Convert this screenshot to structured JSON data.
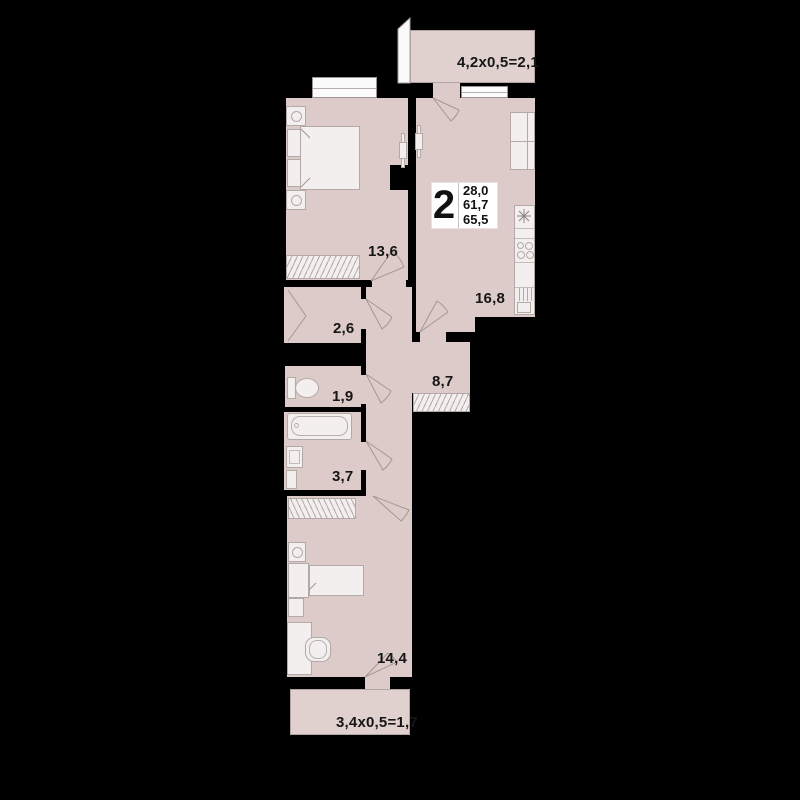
{
  "apartment": {
    "badge": {
      "rooms_count": "2",
      "area_lines": {
        "living": "28,0",
        "usable": "61,7",
        "total": "65,5"
      }
    },
    "rooms": {
      "bedroom": {
        "area": "13,6"
      },
      "kitchen_living": {
        "area": "16,8"
      },
      "closet": {
        "area": "2,6"
      },
      "wc": {
        "area": "1,9"
      },
      "hallway": {
        "area": "8,7"
      },
      "bathroom": {
        "area": "3,7"
      },
      "bedroom2": {
        "area": "14,4"
      }
    },
    "balconies": {
      "top": {
        "label": "4,2x0,5=2,1"
      },
      "bottom": {
        "label": "3,4x0,5=1,7"
      }
    },
    "colors": {
      "floor": "#dccbc9",
      "furniture": "#f3efee",
      "wall": "#000000",
      "line": "#a3988f",
      "text": "#161616"
    }
  }
}
